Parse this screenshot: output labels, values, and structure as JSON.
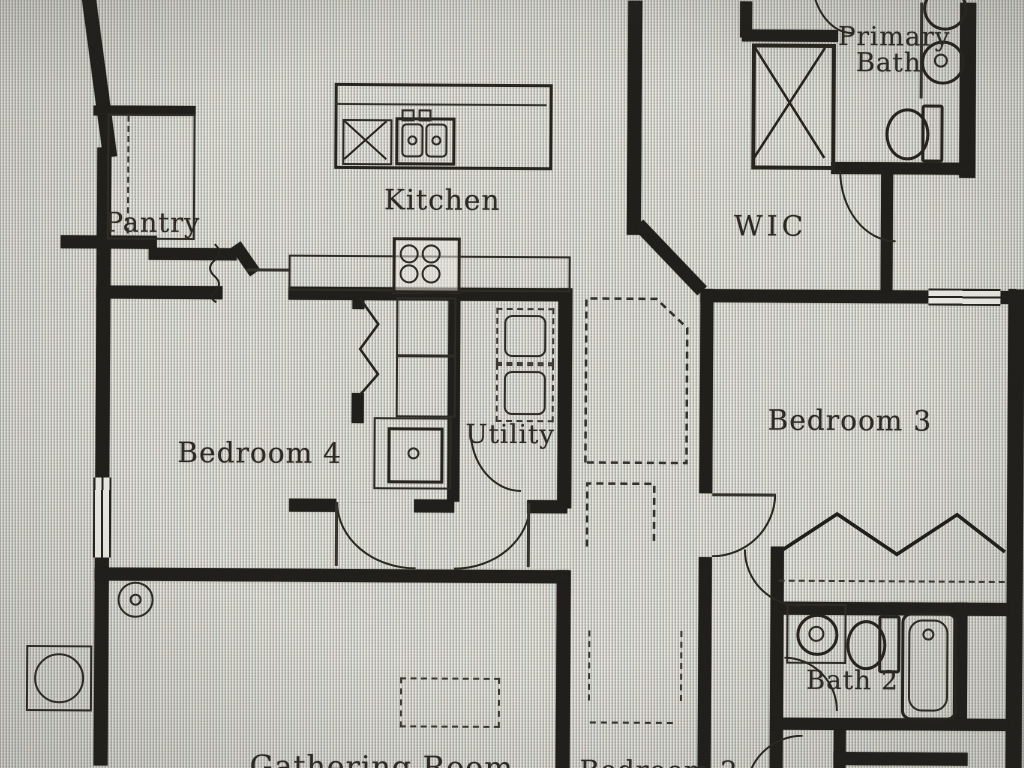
{
  "figure_type": "floor_plan_photo",
  "rooms": {
    "pantry": "Pantry",
    "kitchen": "Kitchen",
    "primary_bath_line1": "Primary",
    "primary_bath_line2": "Bath",
    "wic": "WIC",
    "bedroom4": "Bedroom 4",
    "utility": "Utility",
    "bedroom3": "Bedroom 3",
    "bath2": "Bath 2",
    "bottom_left_partial": "Gathering Room",
    "bottom_center_partial": "Bedroom 2"
  },
  "icons": {
    "shower": "box-with-x-cross",
    "dishwasher": "box-with-x-cross",
    "kitchen_sink": "double-basin-sink",
    "cooktop": "four-burner-circles",
    "vanity_sinks": "two-round-sinks",
    "toilet": "oval-bowl-with-tank",
    "bathtub": "rounded-rect-tub",
    "washer_dryer": "stacked-dashed-boxes",
    "water_heater": "square-with-circle",
    "closet_rod": "zigzag-line",
    "attic_access": "dashed-rectangle",
    "door_swing": "quarter-circle-arc",
    "window": "double-line-in-wall"
  },
  "colors": {
    "paper": "#d5d4cc",
    "wall_ink": "#211f1b",
    "line_ink": "#34332c",
    "label_ink": "#2c2a23"
  }
}
